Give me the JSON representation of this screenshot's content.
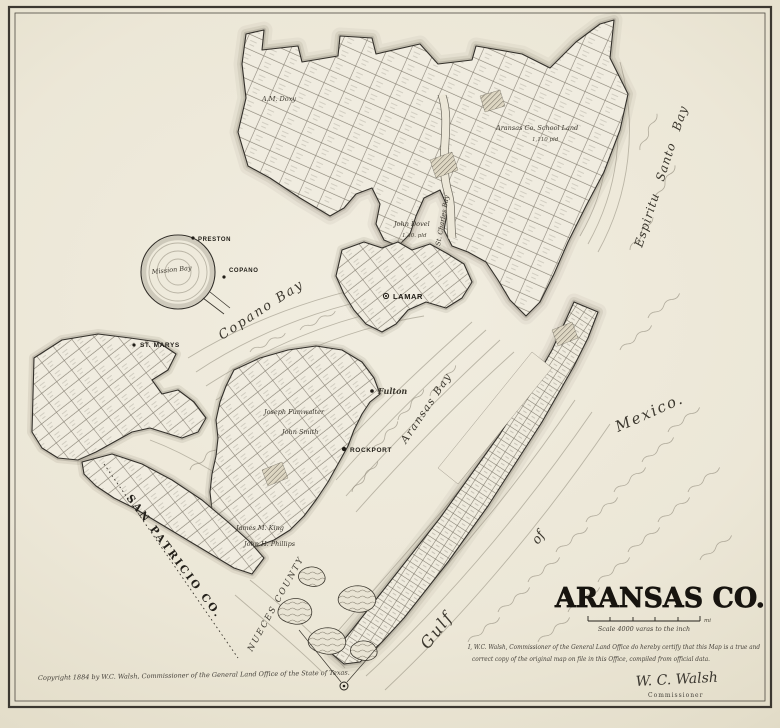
{
  "map": {
    "title": "ARANSAS CO.",
    "scale_caption": "Scale 4000 varas to the inch",
    "scale_unit": "mi",
    "certification_line1": "I, W.C. Walsh, Commissioner of the General Land Office do hereby certify that this Map is a true and",
    "certification_line2": "correct copy of the original map on file in this Office, compiled from official data.",
    "signature": "W. C. Walsh",
    "signature_title": "Commissioner",
    "copyright": "Copyright 1884 by W.C. Walsh, Commissioner of the General Land Office of the State of Texas.",
    "regions": {
      "san_patricio": "SAN PATRICIO CO.",
      "nueces": "NUECES COUNTY"
    },
    "water": {
      "copano": "Copano Bay",
      "aransas": "Aransas Bay",
      "espiritu": "Espiritu Santo Bay",
      "mission": "Mission Bay",
      "st_charles": "St. Charles Bay",
      "gulf": "Gulf",
      "of": "of",
      "mexico": "Mexico."
    },
    "towns": {
      "preston": "PRESTON",
      "copano": "COPANO",
      "st_marys": "ST. MARYS",
      "lamar": "LAMAR",
      "fulton": "Fulton",
      "rockport": "ROCKPORT"
    },
    "surveys": {
      "doxy": "A.M. Doxy",
      "dovel": "John Dovel",
      "dovel_acreage": "1 40. pld",
      "school_land": "Aransas Co. School Land",
      "school_acreage": "1,110 pld",
      "smith": "John Smith",
      "fumwalter": "Joseph Fumwalter",
      "king": "James M. King",
      "phillips": "John H. Phillips"
    },
    "colors": {
      "paper": "#ece7d8",
      "ink": "#2e2a23",
      "water_line": "#8d8779"
    }
  }
}
